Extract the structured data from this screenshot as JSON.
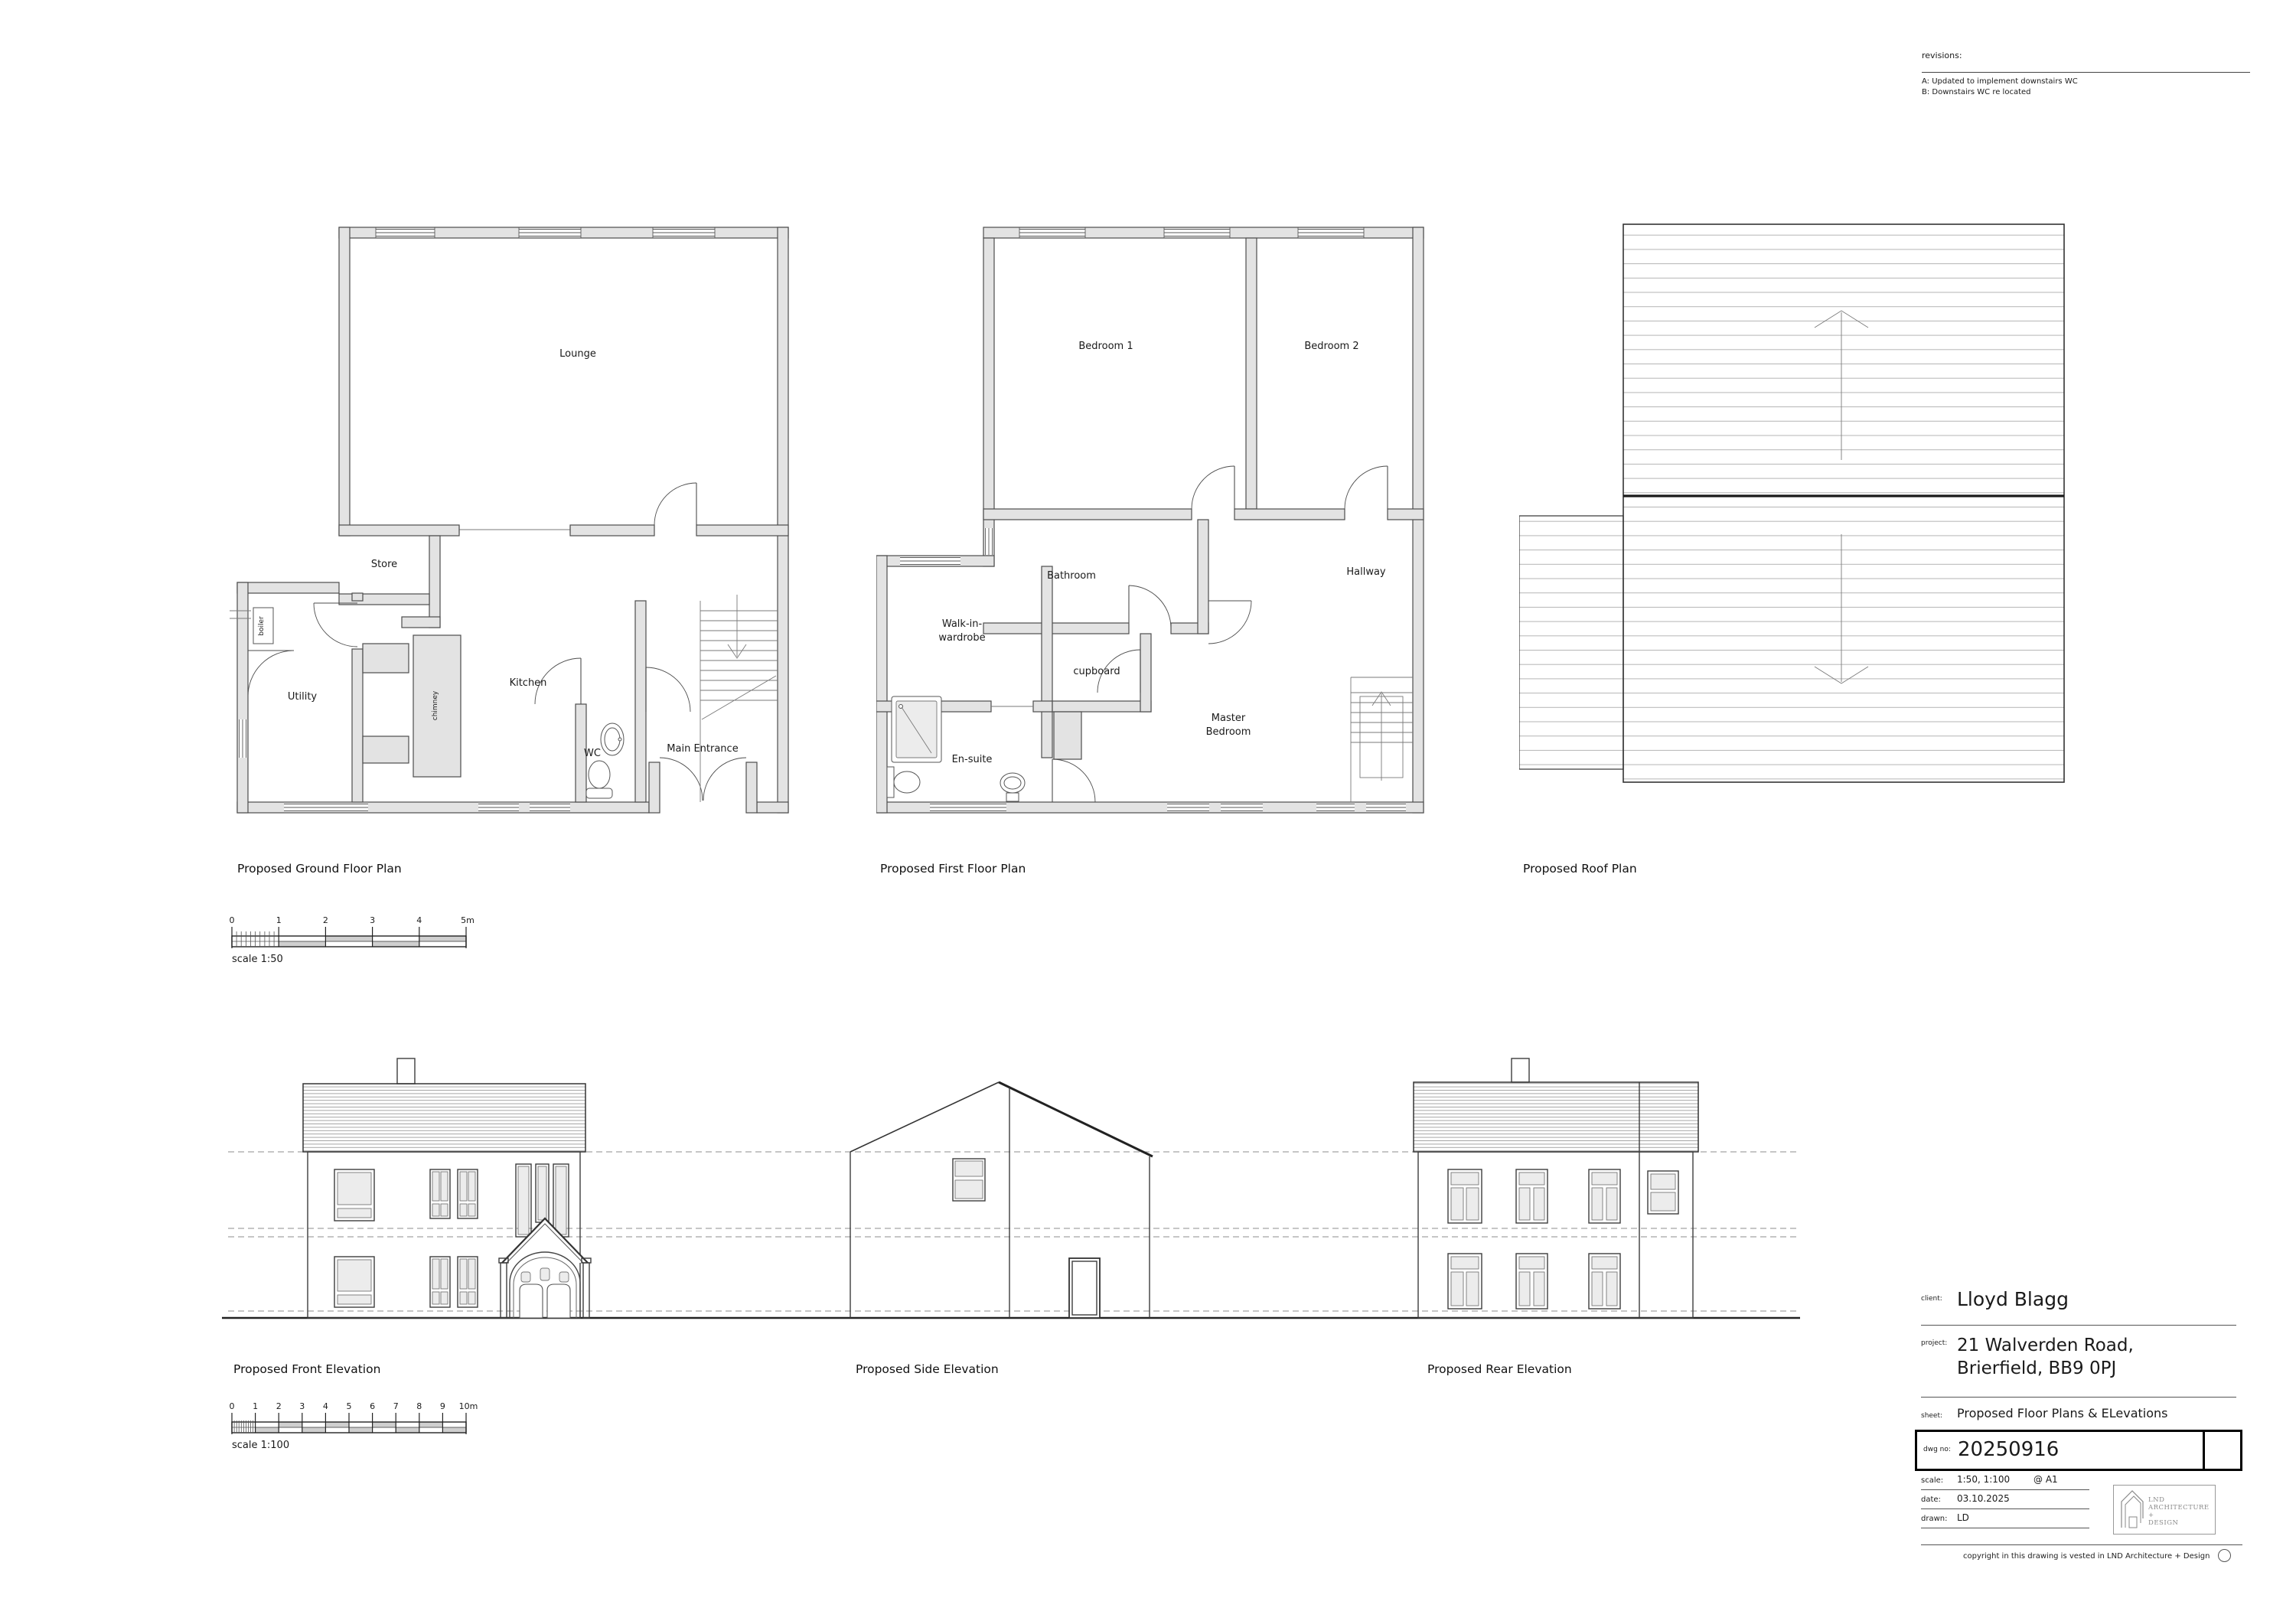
{
  "revisions": {
    "label": "revisions:",
    "items": [
      "A: Updated to implement downstairs WC",
      "B: Downstairs WC re located"
    ]
  },
  "ground_floor": {
    "title": "Proposed Ground Floor Plan",
    "rooms": {
      "lounge": "Lounge",
      "store": "Store",
      "boiler": "boiler",
      "utility": "Utility",
      "chimney": "chimney",
      "kitchen": "Kitchen",
      "wc": "WC",
      "main_entrance": "Main Entrance"
    }
  },
  "first_floor": {
    "title": "Proposed First Floor Plan",
    "rooms": {
      "bedroom1": "Bedroom 1",
      "bedroom2": "Bedroom 2",
      "bathroom": "Bathroom",
      "cupboard": "cupboard",
      "hallway": "Hallway",
      "walk_in_line1": "Walk-in-",
      "walk_in_line2": "wardrobe",
      "master_line1": "Master",
      "master_line2": "Bedroom",
      "ensuite": "En-suite"
    }
  },
  "roof": {
    "title": "Proposed Roof Plan"
  },
  "elevations": {
    "front": "Proposed Front Elevation",
    "side": "Proposed Side Elevation",
    "rear": "Proposed Rear Elevation"
  },
  "scale_bar_50": {
    "caption": "scale 1:50",
    "ticks": [
      "0",
      "1",
      "2",
      "3",
      "4",
      "5m"
    ]
  },
  "scale_bar_100": {
    "caption": "scale 1:100",
    "ticks": [
      "0",
      "1",
      "2",
      "3",
      "4",
      "5",
      "6",
      "7",
      "8",
      "9",
      "10m"
    ]
  },
  "title_block": {
    "client_label": "client:",
    "client": "Lloyd Blagg",
    "project_label": "project:",
    "project_line1": "21 Walverden Road,",
    "project_line2": "Brierfield, BB9 0PJ",
    "sheet_label": "sheet:",
    "sheet": "Proposed Floor Plans & ELevations",
    "dwg_label": "dwg no:",
    "dwg_no": "20250916",
    "scale_label": "scale:",
    "scale": "1:50, 1:100",
    "paper": "@ A1",
    "date_label": "date:",
    "date": "03.10.2025",
    "drawn_label": "drawn:",
    "drawn": "LD",
    "logo_line1": "LND",
    "logo_line2": "ARCHITECTURE +",
    "logo_line3": "DESIGN",
    "copyright": "copyright in this drawing is vested in LND Architecture + Design"
  },
  "colors": {
    "wall_fill": "#e3e3e3",
    "line": "#4d4d4d",
    "dashed_datum": "#8c8c8c",
    "roof_stripe": "#b5b5b5",
    "background": "#ffffff"
  }
}
